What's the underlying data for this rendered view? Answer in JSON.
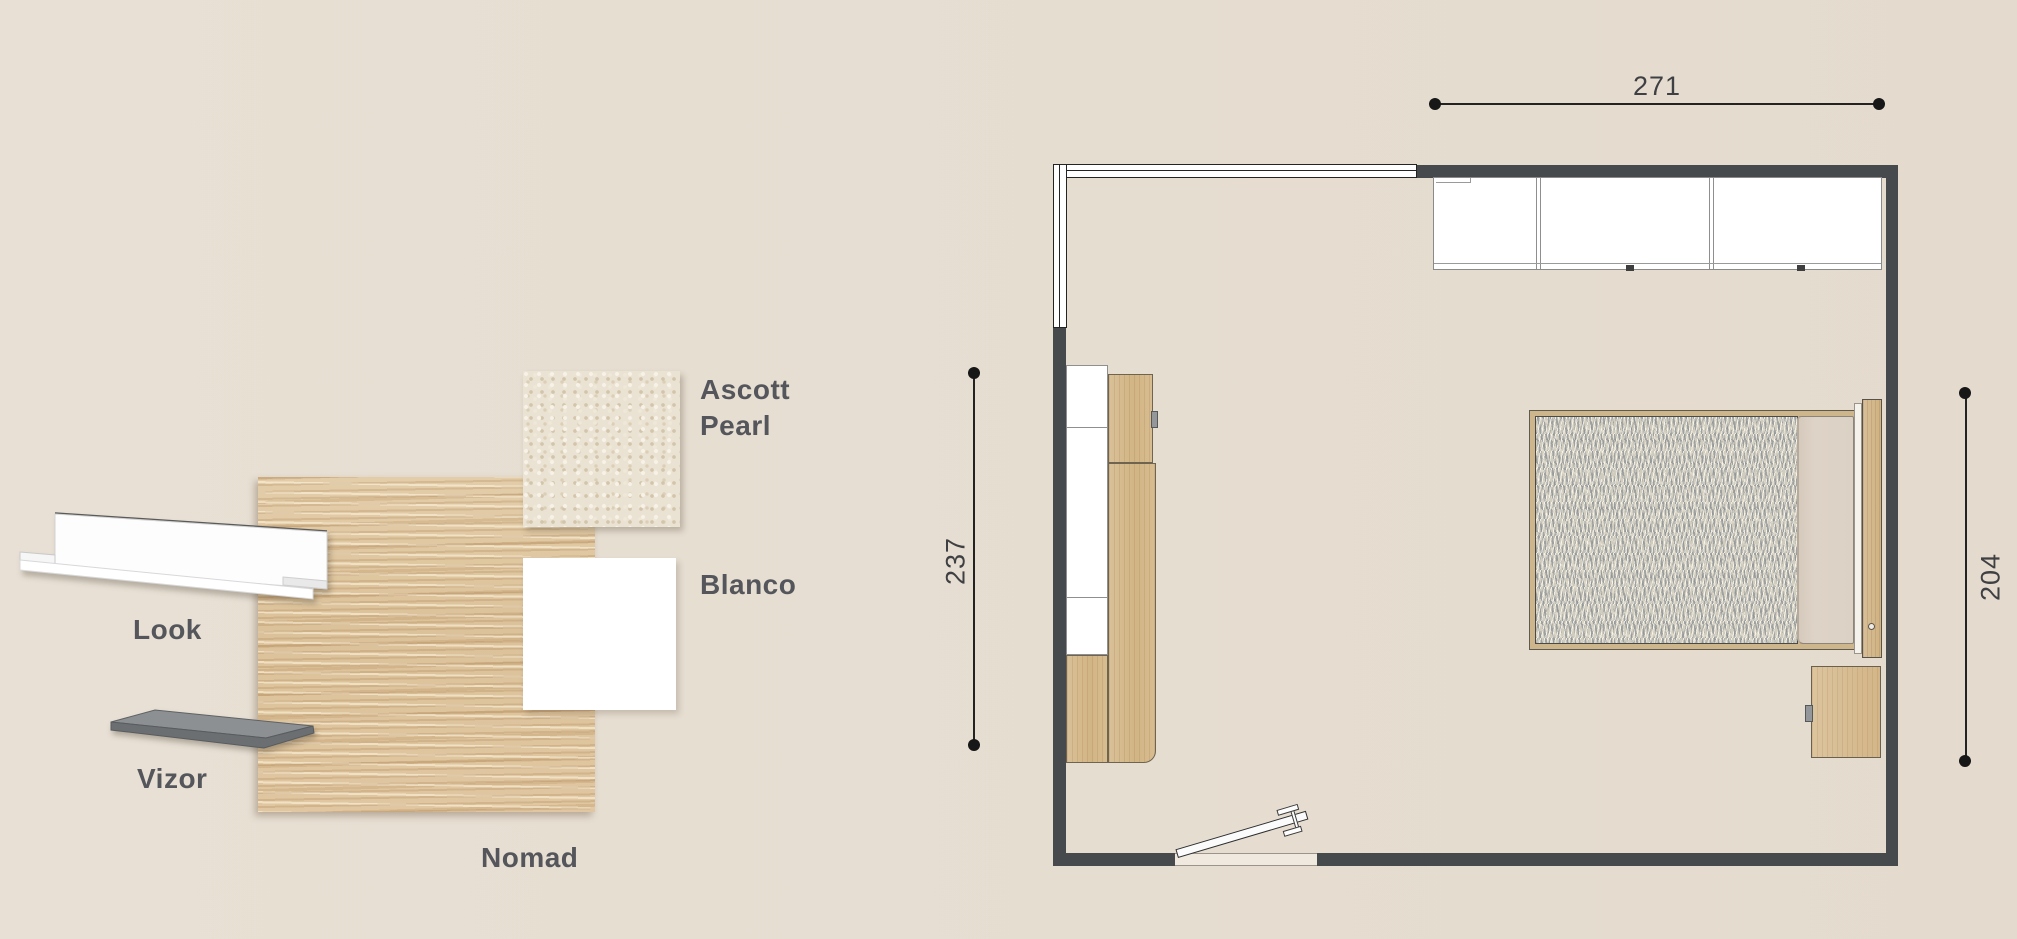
{
  "materials_panel": {
    "shelf_look": {
      "label": "Look"
    },
    "shelf_vizor": {
      "label": "Vizor"
    },
    "wood_nomad": {
      "label": "Nomad"
    },
    "carpet_ascott": {
      "label": "Ascott Pearl"
    },
    "finish_blanco": {
      "label": "Blanco"
    }
  },
  "floor_plan": {
    "dim_top": "271",
    "dim_left": "237",
    "dim_right": "204"
  },
  "colors": {
    "background": "#e6ddd1",
    "wall": "#474a4c",
    "wood": "#d8bd92",
    "label_text": "#54565b",
    "dimension_text": "#3f4043"
  }
}
